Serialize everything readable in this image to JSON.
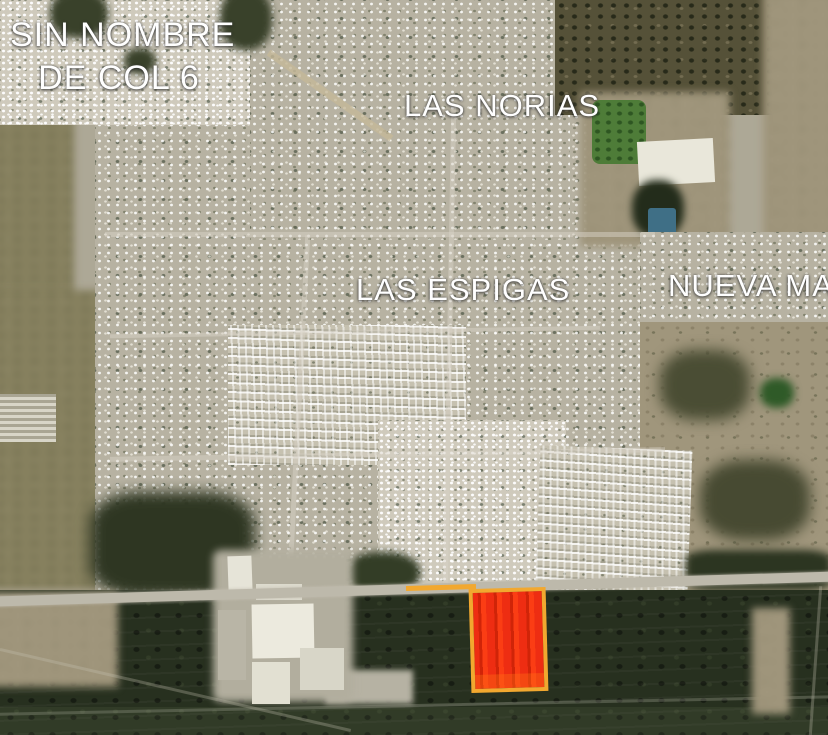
{
  "map": {
    "view": "satellite",
    "label_color": "#ffffff",
    "labels": {
      "sin_nombre": {
        "line1": "SIN NOMBRE",
        "line2": "DE COL 6"
      },
      "las_norias": "LAS NORIAS",
      "las_espigas": "LAS ESPIGAS",
      "nueva_ma": "NUEVA MA"
    }
  },
  "highlight_plot": {
    "border_color": "#f2a82f",
    "fill_color": "#ee2d12",
    "stripe_color": "#d02408",
    "accent_color": "#fb3d14"
  }
}
